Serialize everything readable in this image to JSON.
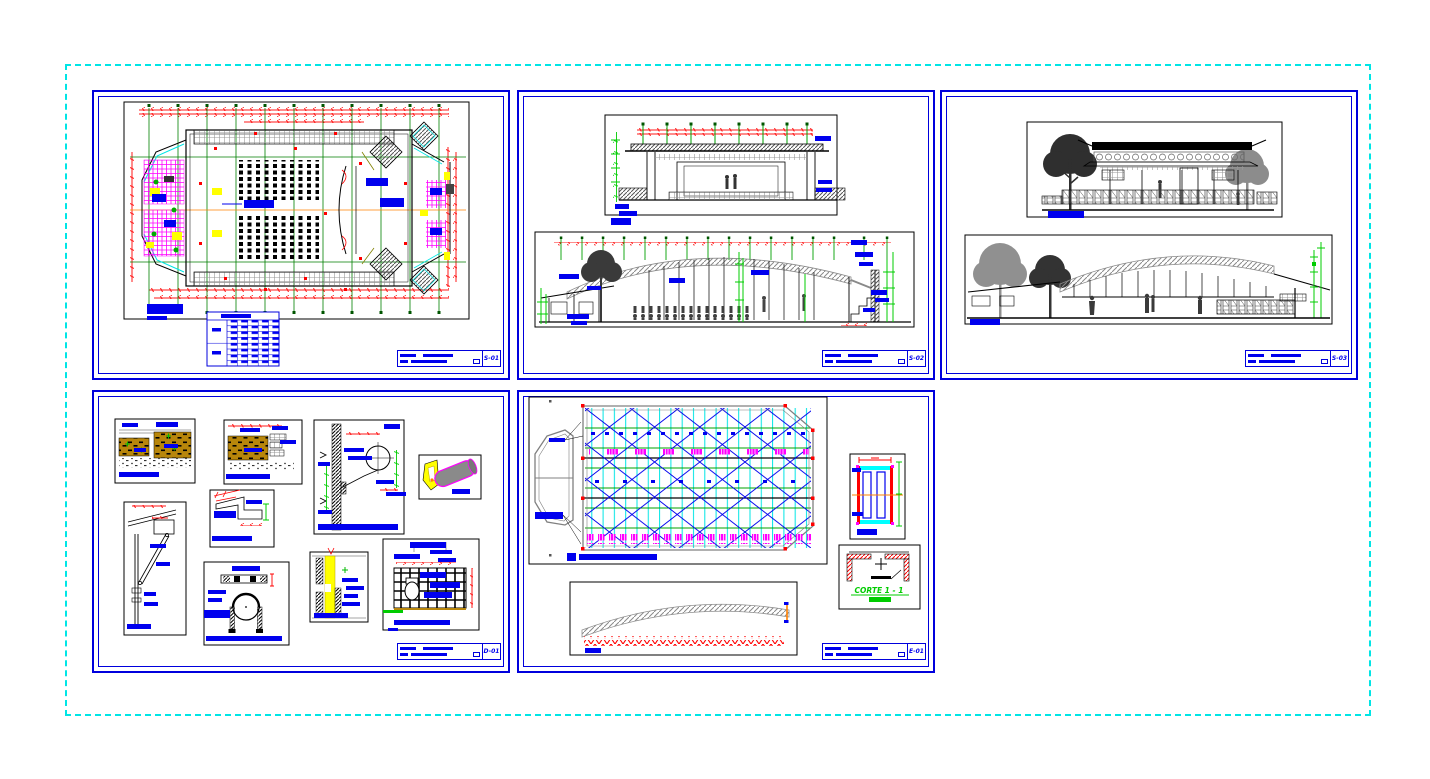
{
  "document": {
    "type": "cad-drawing-set",
    "background": "#FFFFFF",
    "outer_frame_color": "#00E5E5",
    "sheet_border_color": "#0000DD"
  },
  "palette": {
    "blue": "#0000EE",
    "red": "#FF0000",
    "grid_green": "#008000",
    "dim_green": "#00CC00",
    "cyan": "#00FFFF",
    "magenta": "#FF00FF",
    "yellow": "#FFFF00",
    "earth_goldenrod": "#B8860B",
    "truss_gray": "#8A8A8A",
    "orange": "#FF8000",
    "black": "#000000"
  },
  "sheets": [
    {
      "code": "S-01",
      "description": "auditorium floor plan with seating, stage and schedule table"
    },
    {
      "code": "S-02",
      "description": "cross section and longitudinal section with arched truss roof"
    },
    {
      "code": "S-03",
      "description": "front and side elevations with trees"
    },
    {
      "code": "D-01",
      "description": "construction details: foundations, flashing, pipe clamp, joints, lattice"
    },
    {
      "code": "E-01",
      "description": "roof framing plan, truss elevation and connection details"
    }
  ],
  "labels": {
    "corte": "CORTE 1 - 1"
  }
}
